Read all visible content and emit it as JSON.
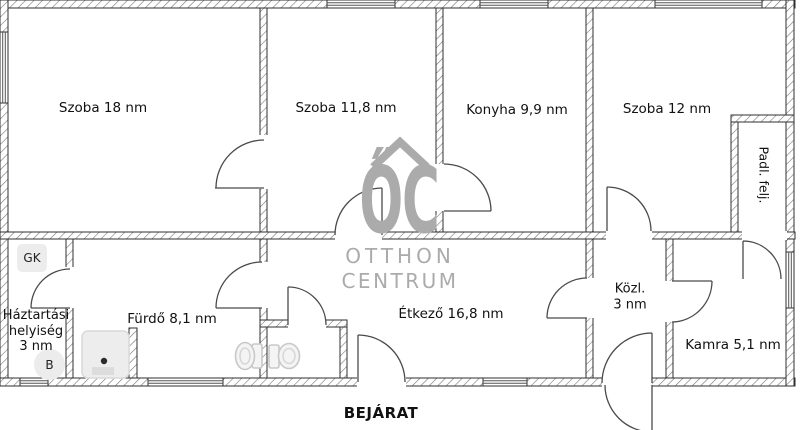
{
  "plan": {
    "labels": {
      "szoba18": "Szoba 18 nm",
      "szoba118": "Szoba 11,8 nm",
      "konyha": "Konyha 9,9 nm",
      "szoba12": "Szoba 12 nm",
      "padl_felj": "Padl. felj.",
      "haztartasi_l1": "Háztartási",
      "haztartasi_l2": "helyiség",
      "haztartasi_l3": "3 nm",
      "gk": "GK",
      "b": "B",
      "furdo": "Fürdő 8,1 nm",
      "etkezo": "Étkező 16,8 nm",
      "kozl_l1": "Közl.",
      "kozl_l2": "3 nm",
      "kamra": "Kamra 5,1 nm",
      "bejarat": "BEJÁRAT"
    },
    "watermark": {
      "logo": "ŐC",
      "line1": "OTTHON",
      "line2": "CENTRUM"
    },
    "colors": {
      "wall_line": "#2f2f2f",
      "hatch_line": "#777777",
      "door_line": "#4a4a4a",
      "text": "#111111",
      "watermark": "#ababab",
      "fixture_fill": "#ececec"
    }
  }
}
